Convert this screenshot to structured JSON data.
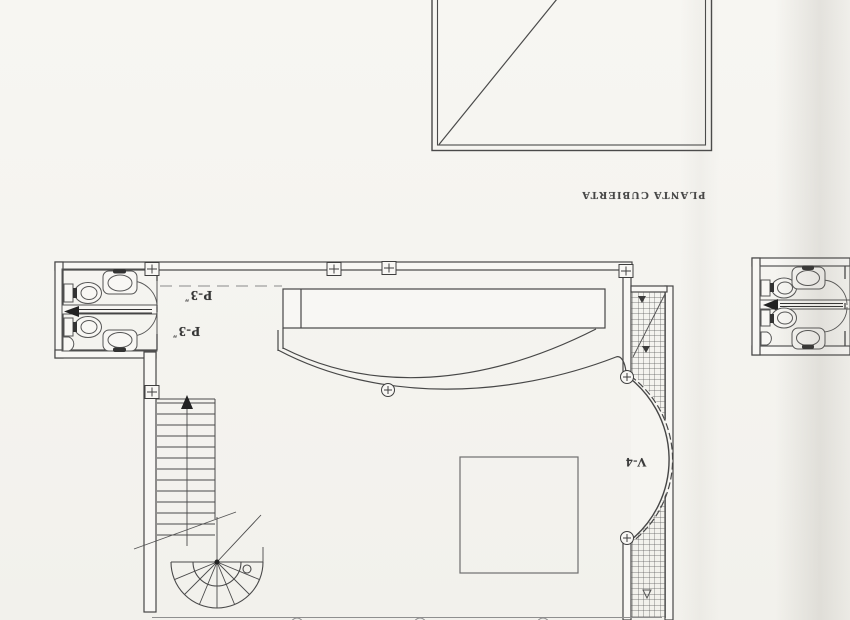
{
  "labels": {
    "roof_plan_caption": "PLANTA CUBIERTA",
    "door_label_top": {
      "text": "P-3",
      "mark": "″"
    },
    "door_label_bottom": {
      "text": "P-3",
      "mark": "″"
    },
    "window_label": "V-4"
  },
  "symbols": {
    "square_column_marker": "⊞",
    "round_column_marker": "⊕",
    "stair_direction_arrow": "▲"
  },
  "colors": {
    "paper": "#f5f4f0",
    "ink": "#474747",
    "ink_light": "#8a8a8a",
    "hatch": "#5a5a5a",
    "scan_shade": "#e9e7e2"
  }
}
